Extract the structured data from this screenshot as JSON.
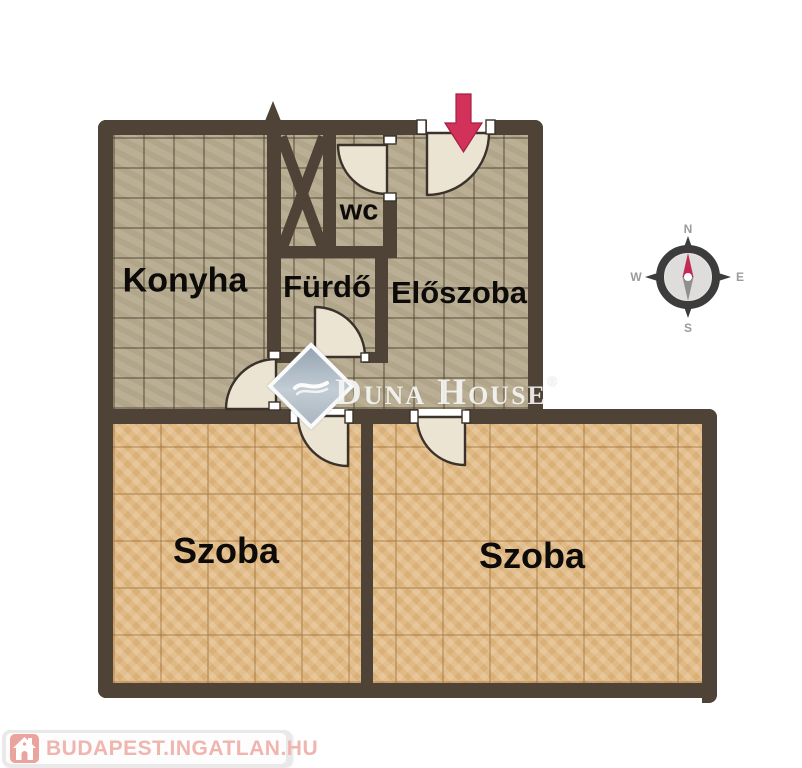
{
  "floorplan": {
    "wall_color": "#4f4337",
    "tile_floor_color": "#b6ab8f",
    "parquet_floor_color": "#e0b984",
    "door_leaf_color": "#ece4d2",
    "entrance_arrow_color": "#d2315a",
    "labels": {
      "konyha": "Konyha",
      "furdo": "Fürdő",
      "wc": "wc",
      "eloszoba": "Előszoba",
      "szoba_left": "Szoba",
      "szoba_right": "Szoba"
    }
  },
  "watermark": {
    "brand": "Duna House",
    "registered": "®"
  },
  "compass": {
    "north": "N",
    "east": "E",
    "south": "S",
    "west": "W",
    "needle_color": "#c22a50"
  },
  "footer": {
    "site": "BUDAPEST.INGATLAN.HU",
    "text_color": "#f0b5ae",
    "icon_bg": "#eba39d"
  }
}
